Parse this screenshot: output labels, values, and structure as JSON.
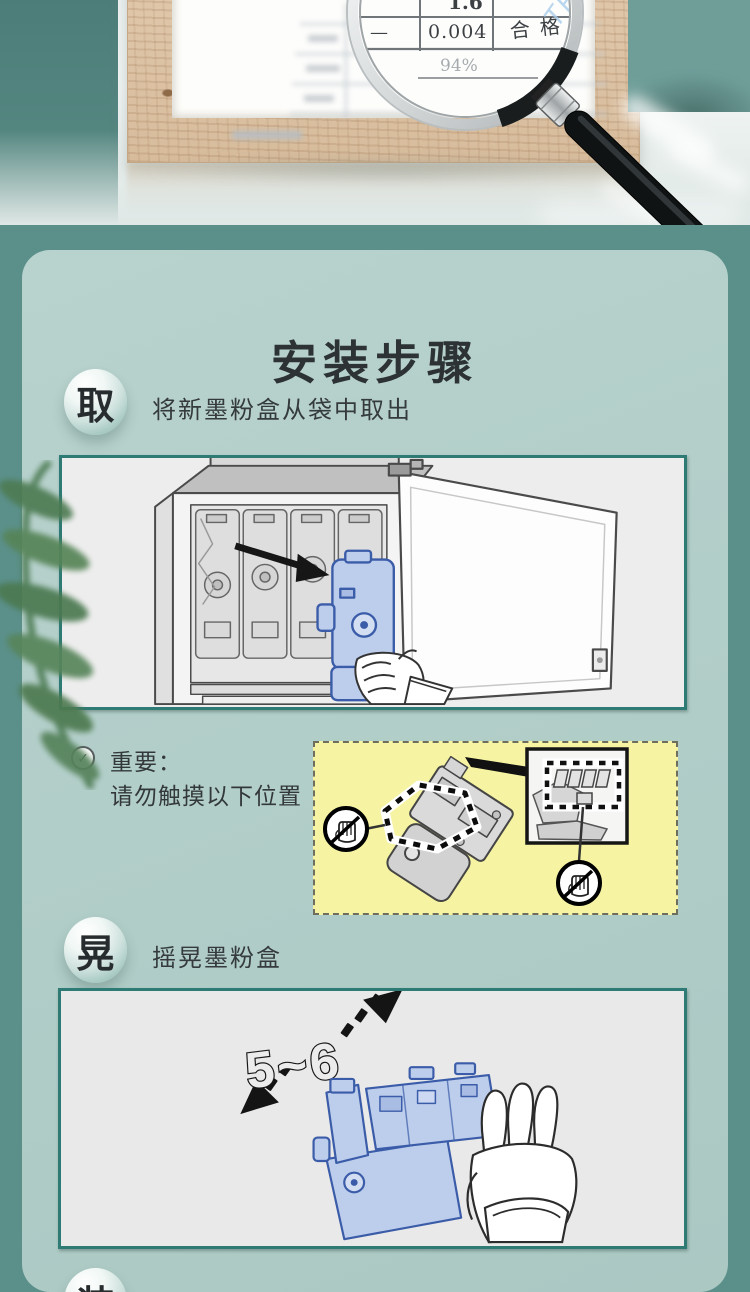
{
  "hero": {
    "magnifier_report": {
      "value_top": "1.6",
      "dash": "—",
      "value_mid": "0.004",
      "result": "合格",
      "percent": "94%",
      "watermark": "TFJC"
    }
  },
  "install": {
    "title": "安装步骤",
    "steps": [
      {
        "badge": "取",
        "label": "将新墨粉盒从袋中取出"
      },
      {
        "badge": "晃",
        "label": "摇晃墨粉盒"
      },
      {
        "badge": "装",
        "label": ""
      }
    ],
    "important": {
      "check": "✓",
      "line1": "重要：",
      "line2": "请勿触摸以下位置"
    },
    "shake_count": "5~6"
  },
  "colors": {
    "page_background": "#5b908a",
    "card_background": "#b1cdc8",
    "panel_border": "#2e7a74",
    "note_background": "#f6f4a2",
    "cartridge_blue": "#bdcdec",
    "cartridge_outline": "#3b5ca8",
    "wood_frame": "#d9bfa2",
    "leaf_green": "#54854c"
  }
}
